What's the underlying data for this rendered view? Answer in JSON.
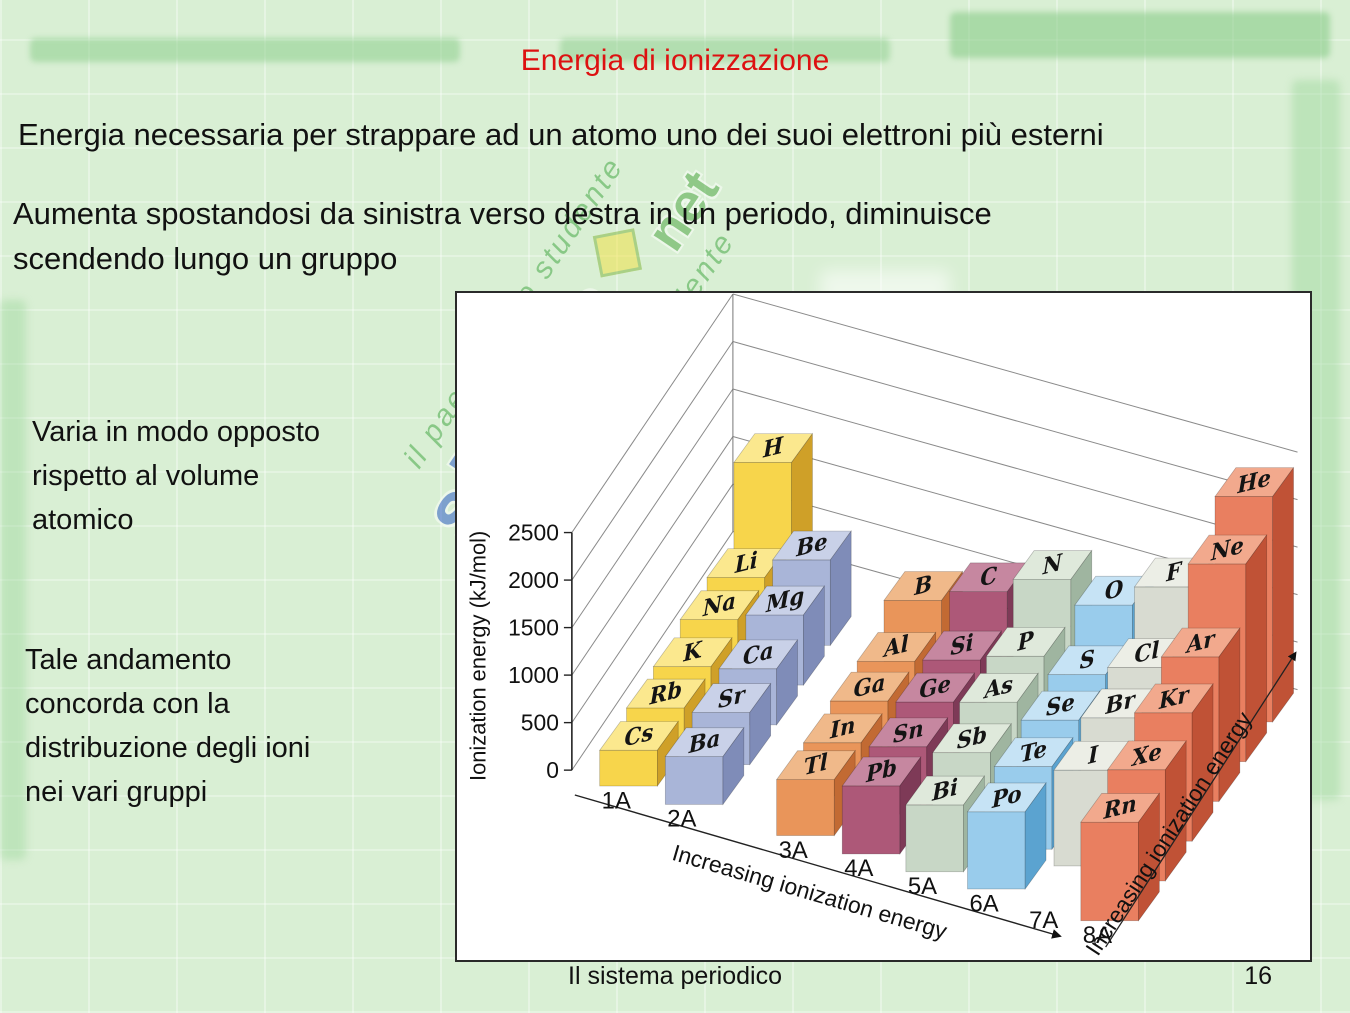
{
  "slide": {
    "title": "Energia di ionizzazione",
    "paragraph1": "Energia necessaria per strappare ad un atomo uno dei suoi elettroni più esterni",
    "paragraph2": "Aumenta spostandosi da sinistra verso destra in un periodo, diminuisce\nscendendo lungo un gruppo",
    "note1": "Varia in modo opposto\nrispetto al volume\natomico",
    "note2": "Tale andamento\nconcorda con la\ndistribuzione degli ioni\nnei vari gruppi",
    "footer": {
      "caption": "Il sistema periodico",
      "page_number": "16"
    }
  },
  "watermark": {
    "logo_text": "skuola",
    "logo_suffix": "net",
    "tagline": "il paese dello studente"
  },
  "chart_data": {
    "type": "bar",
    "projection": "3d",
    "title": "",
    "ylabel": "Ionization energy (kJ/mol)",
    "yticks": [
      0,
      500,
      1000,
      1500,
      2000,
      2500
    ],
    "ylim": [
      0,
      2750
    ],
    "x_axis_label": "Increasing ionization energy",
    "depth_axis_label": "Increasing ionization energy",
    "value_unit": "kJ/mol",
    "groups": [
      {
        "label": "1A",
        "colors": {
          "top": "#fbe88e",
          "front": "#f7d54b",
          "side": "#cfa028"
        },
        "elements": [
          {
            "symbol": "H",
            "period": 1,
            "value": 1312
          },
          {
            "symbol": "Li",
            "period": 2,
            "value": 520
          },
          {
            "symbol": "Na",
            "period": 3,
            "value": 496
          },
          {
            "symbol": "K",
            "period": 4,
            "value": 419
          },
          {
            "symbol": "Rb",
            "period": 5,
            "value": 403
          },
          {
            "symbol": "Cs",
            "period": 6,
            "value": 376
          }
        ]
      },
      {
        "label": "2A",
        "colors": {
          "top": "#c9d1e8",
          "front": "#a9b5d8",
          "side": "#7f8cb8"
        },
        "elements": [
          {
            "symbol": "Be",
            "period": 2,
            "value": 899
          },
          {
            "symbol": "Mg",
            "period": 3,
            "value": 738
          },
          {
            "symbol": "Ca",
            "period": 4,
            "value": 590
          },
          {
            "symbol": "Sr",
            "period": 5,
            "value": 549
          },
          {
            "symbol": "Ba",
            "period": 6,
            "value": 503
          }
        ]
      },
      {
        "label": "3A",
        "colors": {
          "top": "#f0b98a",
          "front": "#e9955a",
          "side": "#c26a33"
        },
        "elements": [
          {
            "symbol": "B",
            "period": 2,
            "value": 801
          },
          {
            "symbol": "Al",
            "period": 3,
            "value": 578
          },
          {
            "symbol": "Ga",
            "period": 4,
            "value": 579
          },
          {
            "symbol": "In",
            "period": 5,
            "value": 558
          },
          {
            "symbol": "Tl",
            "period": 6,
            "value": 589
          }
        ]
      },
      {
        "label": "4A",
        "colors": {
          "top": "#c687a0",
          "front": "#ad5878",
          "side": "#7e3a57"
        },
        "elements": [
          {
            "symbol": "C",
            "period": 2,
            "value": 1086
          },
          {
            "symbol": "Si",
            "period": 3,
            "value": 786
          },
          {
            "symbol": "Ge",
            "period": 4,
            "value": 762
          },
          {
            "symbol": "Sn",
            "period": 5,
            "value": 709
          },
          {
            "symbol": "Pb",
            "period": 6,
            "value": 716
          }
        ]
      },
      {
        "label": "5A",
        "colors": {
          "top": "#dfe9db",
          "front": "#c8d7c6",
          "side": "#9fb5a0"
        },
        "elements": [
          {
            "symbol": "N",
            "period": 2,
            "value": 1402
          },
          {
            "symbol": "P",
            "period": 3,
            "value": 1012
          },
          {
            "symbol": "As",
            "period": 4,
            "value": 947
          },
          {
            "symbol": "Sb",
            "period": 5,
            "value": 834
          },
          {
            "symbol": "Bi",
            "period": 6,
            "value": 703
          }
        ]
      },
      {
        "label": "6A",
        "colors": {
          "top": "#c6e3f5",
          "front": "#99ccec",
          "side": "#5ba3d0"
        },
        "elements": [
          {
            "symbol": "O",
            "period": 2,
            "value": 1314
          },
          {
            "symbol": "S",
            "period": 3,
            "value": 1000
          },
          {
            "symbol": "Se",
            "period": 4,
            "value": 941
          },
          {
            "symbol": "Te",
            "period": 5,
            "value": 869
          },
          {
            "symbol": "Po",
            "period": 6,
            "value": 812
          }
        ]
      },
      {
        "label": "7A",
        "colors": {
          "top": "#eceee6",
          "front": "#d8dbd1",
          "side": "#b2b6ab"
        },
        "elements": [
          {
            "symbol": "F",
            "period": 2,
            "value": 1681
          },
          {
            "symbol": "Cl",
            "period": 3,
            "value": 1251
          },
          {
            "symbol": "Br",
            "period": 4,
            "value": 1140
          },
          {
            "symbol": "I",
            "period": 5,
            "value": 1008
          }
        ]
      },
      {
        "label": "8A",
        "colors": {
          "top": "#f2a98d",
          "front": "#e97f60",
          "side": "#c05236"
        },
        "elements": [
          {
            "symbol": "He",
            "period": 1,
            "value": 2372
          },
          {
            "symbol": "Ne",
            "period": 2,
            "value": 2081
          },
          {
            "symbol": "Ar",
            "period": 3,
            "value": 1521
          },
          {
            "symbol": "Kr",
            "period": 4,
            "value": 1351
          },
          {
            "symbol": "Xe",
            "period": 5,
            "value": 1170
          },
          {
            "symbol": "Rn",
            "period": 6,
            "value": 1037
          }
        ]
      }
    ]
  }
}
